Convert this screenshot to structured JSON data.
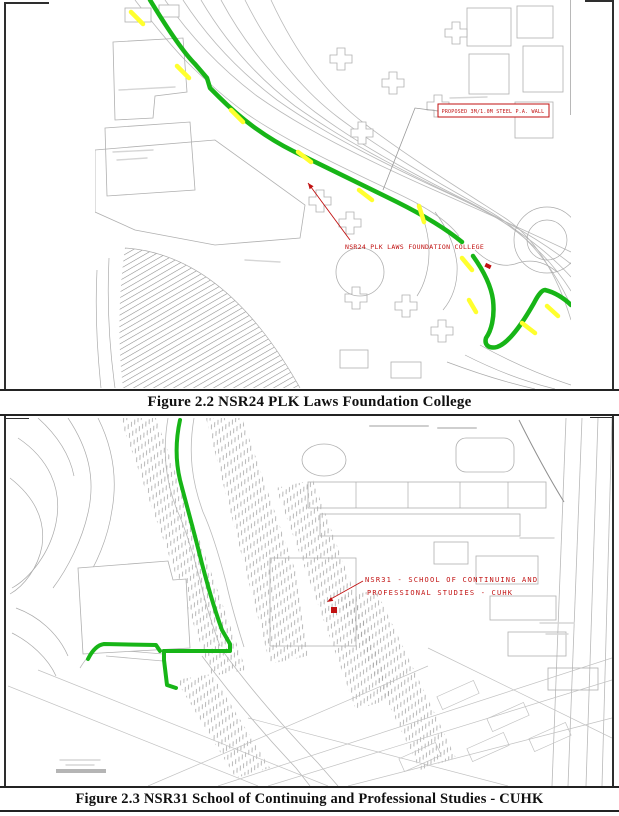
{
  "document": {
    "figures": [
      {
        "caption": "Figure 2.2 NSR24 PLK Laws Foundation College",
        "annotations": {
          "nsr_label": "NSR24  PLK LAWS FOUNDATION COLLEGE",
          "barrier_label": "PROPOSED 3M/1.0M STEEL P.A. WALL"
        },
        "colors": {
          "route": "#17B517",
          "marker": "#FFFF2E",
          "annotation": "#C11111"
        }
      },
      {
        "caption": "Figure 2.3 NSR31 School of Continuing and Professional Studies - CUHK",
        "annotations": {
          "nsr_label_line1": "NSR31 - SCHOOL OF CONTINUING AND",
          "nsr_label_line2": "PROFESSIONAL STUDIES - CUHK"
        },
        "colors": {
          "route": "#17B517",
          "annotation": "#C11111"
        }
      }
    ]
  }
}
